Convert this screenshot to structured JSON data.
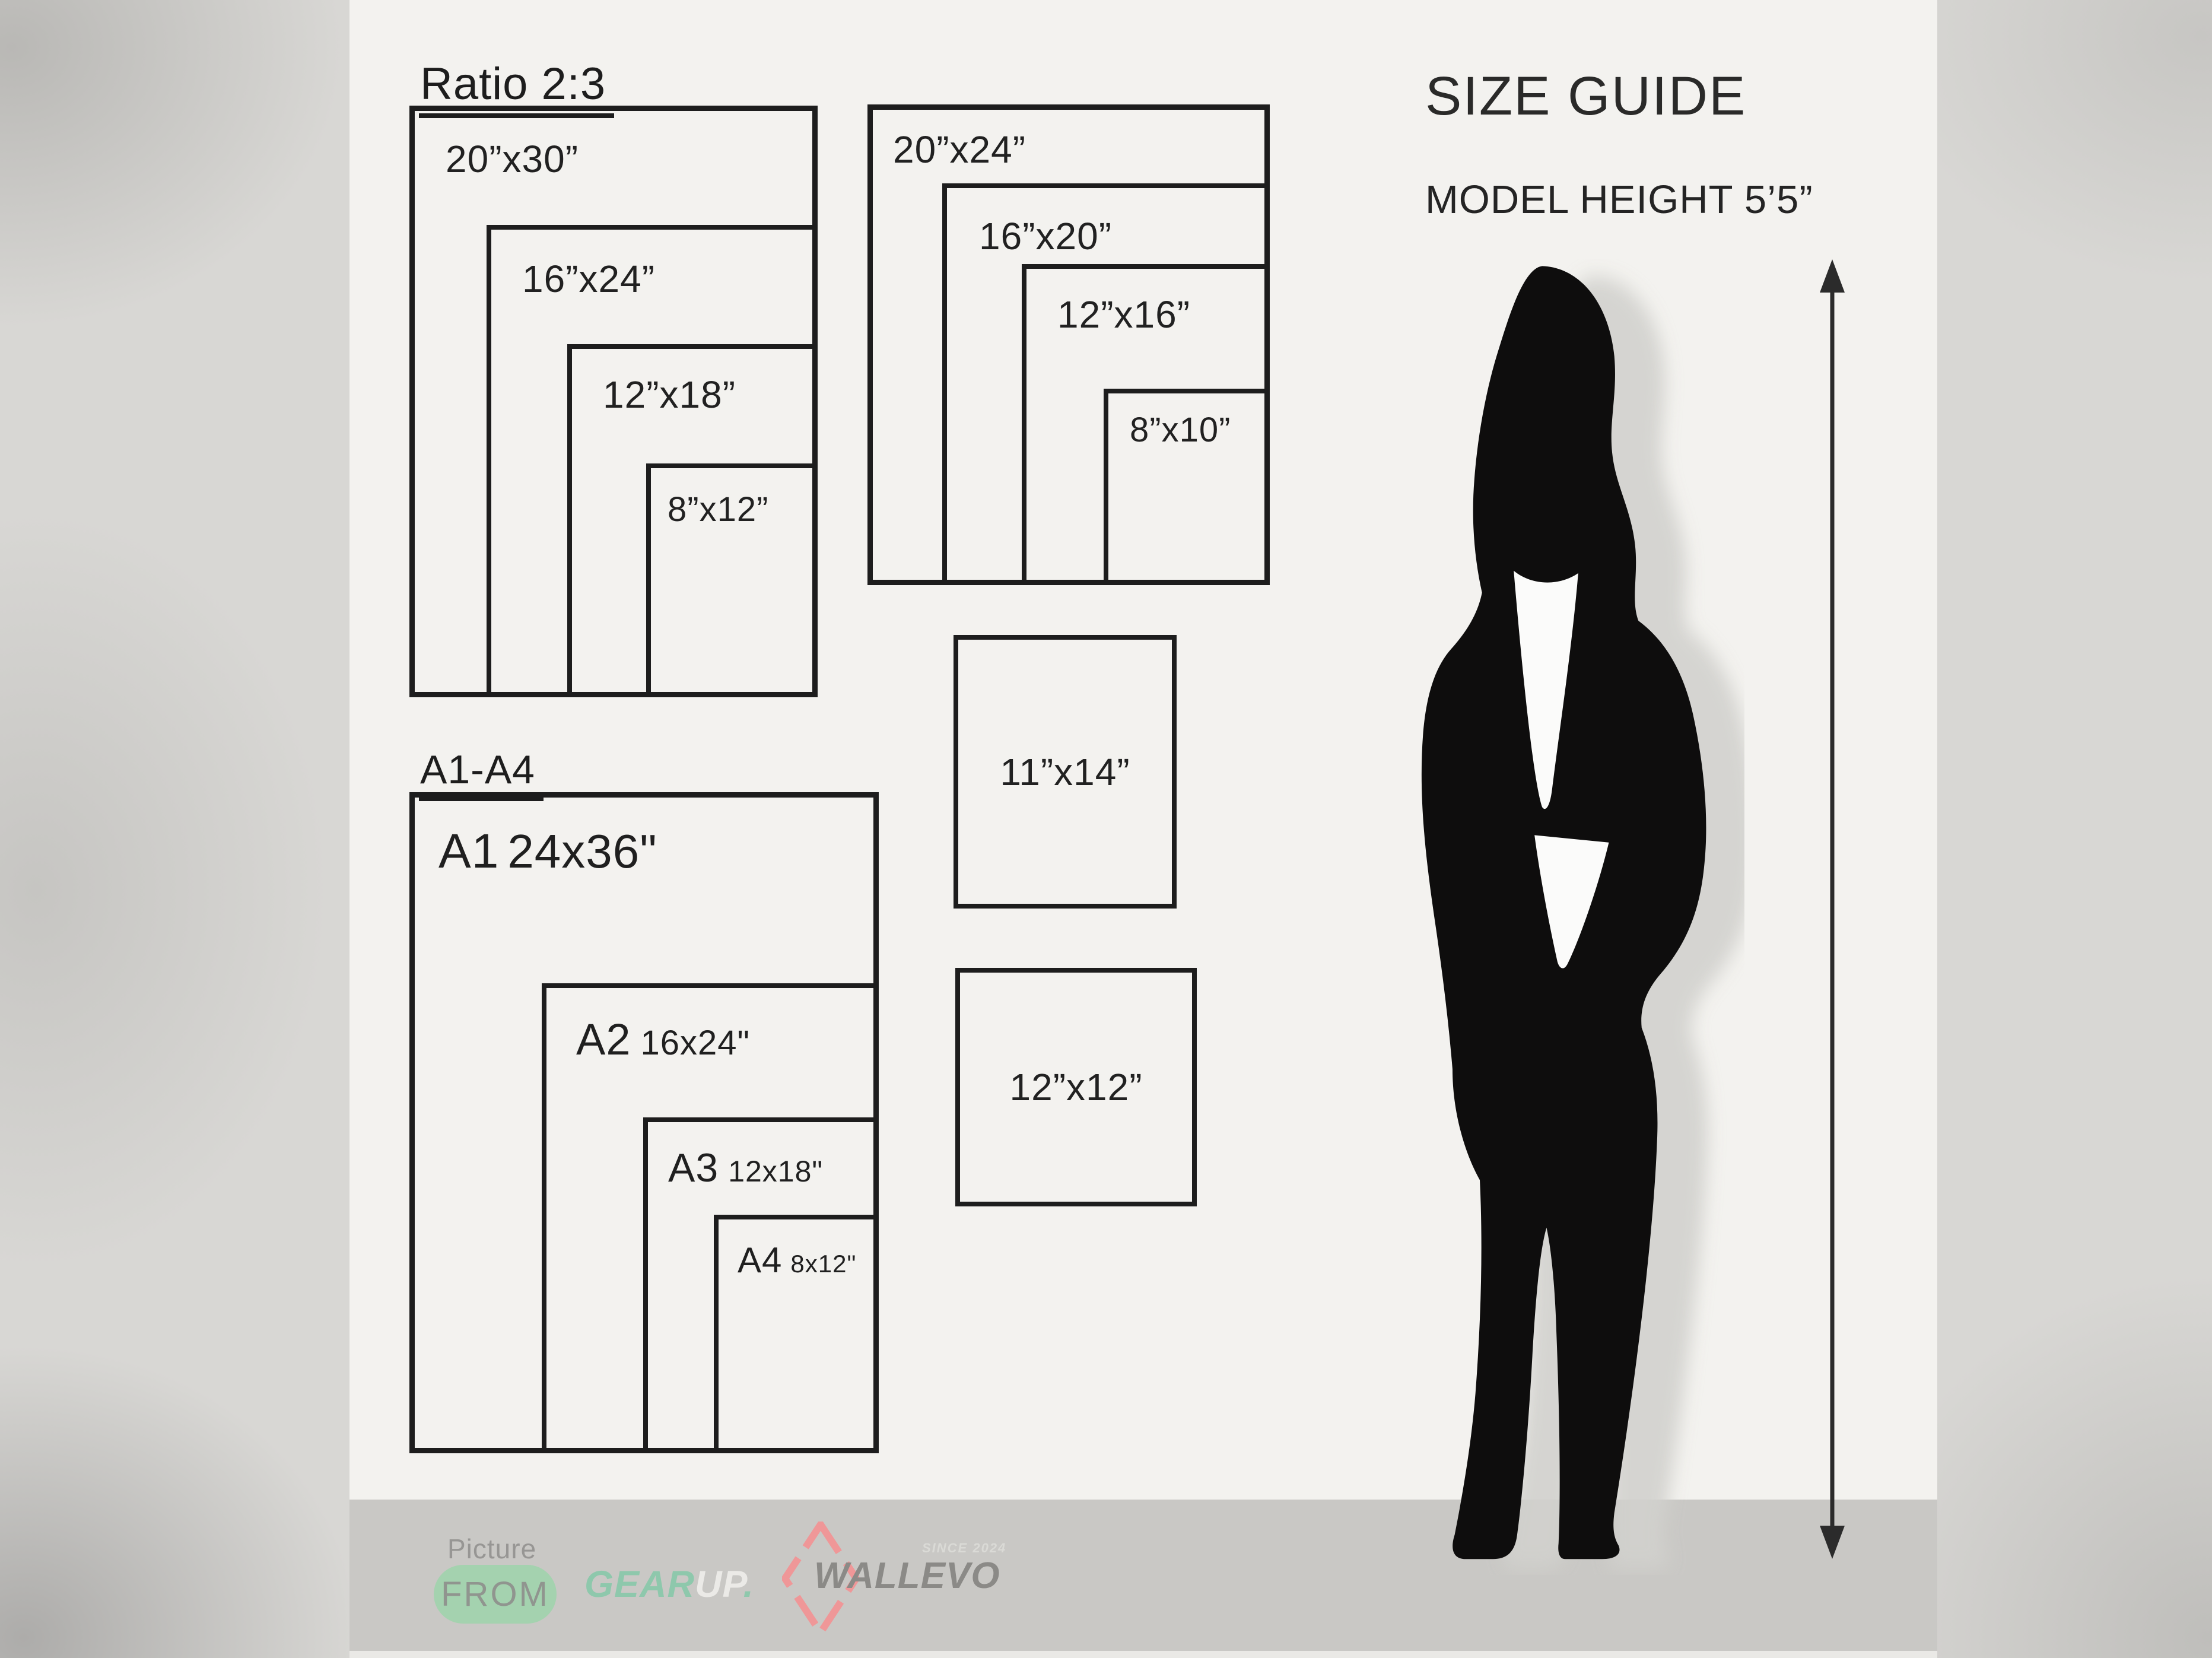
{
  "header": {
    "title": "SIZE GUIDE",
    "model_height": "MODEL HEIGHT 5’5”"
  },
  "ratio_group": {
    "title": "Ratio 2:3",
    "sizes": [
      "20”x30”",
      "16”x24”",
      "12”x18”",
      "8”x12”"
    ]
  },
  "standard_group": {
    "sizes": [
      "20”x24”",
      "16”x20”",
      "12”x16”",
      "8”x10”"
    ]
  },
  "single_boxes": {
    "sizes": [
      "11”x14”",
      "12”x12”"
    ]
  },
  "a_series": {
    "title": "A1-A4",
    "items": [
      {
        "code": "A1",
        "size": "24x36\""
      },
      {
        "code": "A2",
        "size": "16x24\""
      },
      {
        "code": "A3",
        "size": "12x18\""
      },
      {
        "code": "A4",
        "size": "8x12\""
      }
    ]
  },
  "footer": {
    "picture_label": "Picture",
    "from_label": "FROM",
    "gearup": {
      "gear": "GEAR",
      "up": "UP",
      "dot": "."
    },
    "wallevo": {
      "name": "WALLEVO",
      "since": "SINCE 2024"
    }
  },
  "icons": {
    "silhouette": "woman-silhouette",
    "measure_arrow": "height-measure-arrow",
    "diamond": "wallevo-diamond-logo"
  },
  "colors": {
    "panel_bg": "#f3f2ef",
    "footer_bg": "#c9c8c5",
    "box_line": "#1d1d1d",
    "pill_green": "#a4d2af",
    "gear_teal": "#8ec8ac",
    "up_white": "#ebeae7",
    "wallevo_gray": "#8b8a87",
    "diamond_pink": "#ef9798",
    "silhouette_black": "#0e0d0d"
  }
}
